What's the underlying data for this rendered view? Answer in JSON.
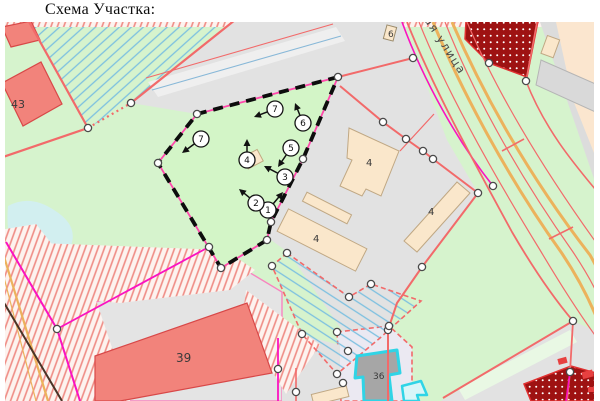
{
  "page": {
    "title": "Схема Участка:"
  },
  "map": {
    "street_label": "ая улица",
    "building_labels": [
      {
        "name": "label-building-43",
        "text": "43",
        "x": 11,
        "y": 108,
        "size": 11
      },
      {
        "name": "label-building-39",
        "text": "39",
        "x": 176,
        "y": 362,
        "size": 12
      },
      {
        "name": "label-building-4a",
        "text": "4",
        "x": 366,
        "y": 166,
        "size": 10
      },
      {
        "name": "label-building-4b",
        "text": "4",
        "x": 428,
        "y": 215,
        "size": 10
      },
      {
        "name": "label-building-4c",
        "text": "4",
        "x": 313,
        "y": 242,
        "size": 10
      },
      {
        "name": "label-building-6",
        "text": "6",
        "x": 388,
        "y": 37,
        "size": 9
      },
      {
        "name": "label-building-36",
        "text": "36",
        "x": 373,
        "y": 379,
        "size": 9
      }
    ],
    "survey_points": [
      {
        "n": "1",
        "x": 268,
        "y": 210,
        "tx": 283,
        "ty": 192
      },
      {
        "n": "2",
        "x": 256,
        "y": 203,
        "tx": 239,
        "ty": 189
      },
      {
        "n": "3",
        "x": 285,
        "y": 177,
        "tx": 264,
        "ty": 166
      },
      {
        "n": "4",
        "x": 247,
        "y": 160,
        "tx": 247,
        "ty": 139
      },
      {
        "n": "5",
        "x": 291,
        "y": 148,
        "tx": 278,
        "ty": 167
      },
      {
        "n": "6",
        "x": 303,
        "y": 123,
        "tx": 295,
        "ty": 103
      },
      {
        "n": "7",
        "x": 275,
        "y": 109,
        "tx": 254,
        "ty": 117
      },
      {
        "n": "7",
        "x": 201,
        "y": 139,
        "tx": 182,
        "ty": 153
      }
    ],
    "vertex_points": [
      [
        338,
        77
      ],
      [
        197,
        114
      ],
      [
        158,
        163
      ],
      [
        209,
        247
      ],
      [
        221,
        268
      ],
      [
        267,
        240
      ],
      [
        271,
        222
      ],
      [
        303,
        159
      ],
      [
        88,
        128
      ],
      [
        131,
        103
      ],
      [
        413,
        58
      ],
      [
        383,
        122
      ],
      [
        406,
        139
      ],
      [
        423,
        151
      ],
      [
        433,
        159
      ],
      [
        478,
        193
      ],
      [
        493,
        186
      ],
      [
        422,
        267
      ],
      [
        388,
        330
      ],
      [
        526,
        81
      ],
      [
        489,
        63
      ],
      [
        57,
        329
      ],
      [
        278,
        369
      ],
      [
        296,
        392
      ],
      [
        287,
        253
      ],
      [
        272,
        266
      ],
      [
        349,
        297
      ],
      [
        371,
        284
      ],
      [
        337,
        374
      ],
      [
        302,
        334
      ],
      [
        337,
        332
      ],
      [
        389,
        326
      ],
      [
        348,
        351
      ],
      [
        343,
        383
      ],
      [
        573,
        321
      ],
      [
        570,
        372
      ]
    ],
    "colors": {
      "base_green": "#d6f3cd",
      "parcel_green": "#d3f5c7",
      "gray_area": "#e2e2e2",
      "building_beige": "#fae7cb",
      "building_red": "#f2837b",
      "building_darkred": "#9e1212",
      "cadastral_red": "#f26a6a",
      "magenta": "#fb12c1",
      "orange_road": "#ecb25c",
      "boundary_black": "#0d0d0d",
      "boundary_pink": "#ff49ac",
      "hatch_blue": "#7cc0e0",
      "hatch_red": "#ef8b84",
      "pond_blue": "#d2eff0",
      "cyan_building": "#2fd4e6",
      "peach": "#fbe6cf",
      "lavender_parcel": "#ebe9f2"
    }
  }
}
